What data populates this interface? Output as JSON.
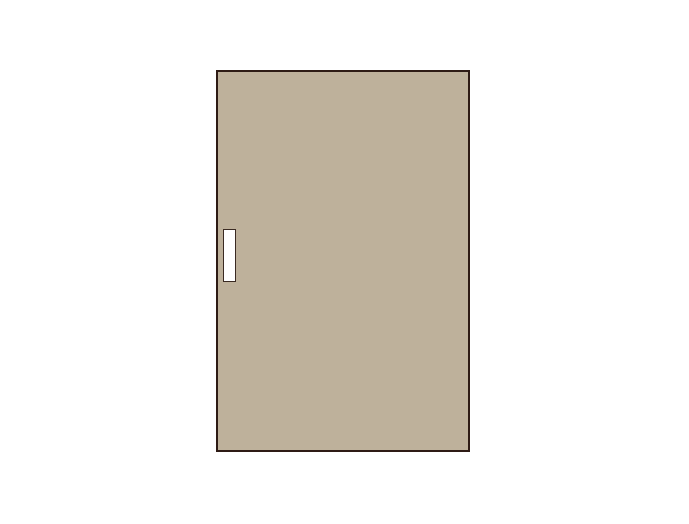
{
  "scene": {
    "type": "door-illustration",
    "elements": [
      {
        "name": "door-panel",
        "shape": "rectangle"
      },
      {
        "name": "door-handle",
        "shape": "rectangle"
      }
    ]
  },
  "colors": {
    "background": "#ffffff",
    "door_fill": "#beb19b",
    "door_border": "#2e1b15",
    "handle_fill": "#ffffff",
    "handle_border": "#3a2a22"
  }
}
